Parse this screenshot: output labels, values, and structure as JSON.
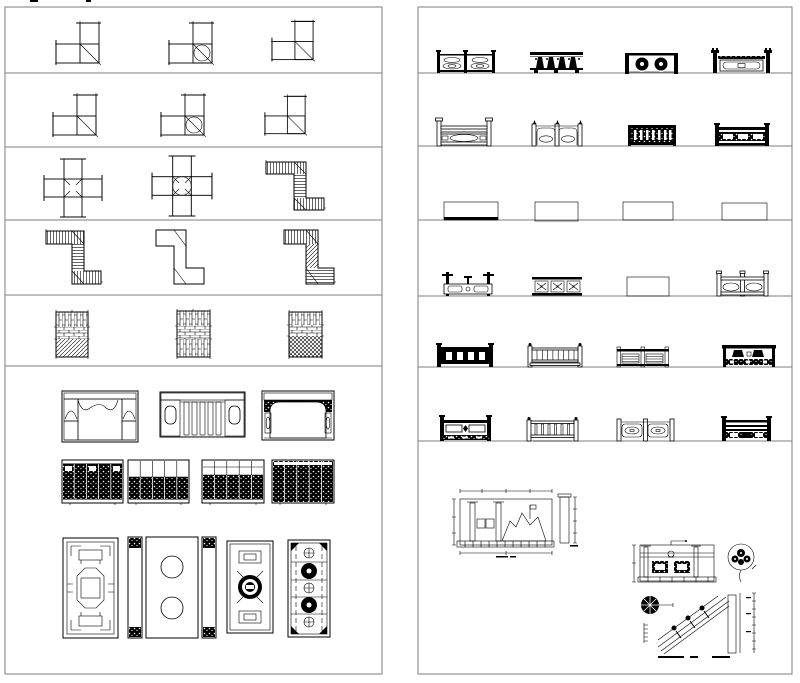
{
  "window": {
    "width": 800,
    "height": 683,
    "background": "#ffffff"
  },
  "style": {
    "ink": "#000000",
    "frame_line": "#7c7c7c",
    "paper": "#ffffff"
  },
  "sheets": [
    {
      "id": "left",
      "title": "brick-wall-junction-plans-and-lattice-screens",
      "rows": [
        {
          "id": "row-1",
          "items": [
            "brick-wall-l-corner-a",
            "brick-wall-l-corner-with-medallion-a",
            "brick-wall-l-corner-b"
          ]
        },
        {
          "id": "row-2",
          "items": [
            "brick-wall-l-corner-c",
            "brick-wall-l-corner-with-medallion-b",
            "brick-wall-l-corner-d"
          ]
        },
        {
          "id": "row-3",
          "items": [
            "brick-wall-cross-junction",
            "brick-wall-cross-junction-with-medallion",
            "brick-wall-z-corner-a"
          ]
        },
        {
          "id": "row-4",
          "items": [
            "brick-wall-z-corner-b",
            "brick-wall-z-corner-dark",
            "brick-wall-z-corner-c"
          ]
        },
        {
          "id": "row-5",
          "items": [
            "brick-bond-panel-a",
            "brick-bond-panel-b",
            "brick-bond-panel-c"
          ]
        },
        {
          "id": "row-6",
          "items": [
            "doorway-screen-curtain-arch",
            "doorway-screen-gate",
            "doorway-screen-wide-arch",
            "folding-screen-a",
            "folding-screen-b",
            "folding-screen-c",
            "folding-screen-d",
            "lattice-window-octagon",
            "lattice-window-ice-crack-triptych",
            "lattice-window-coin-medallion",
            "lattice-window-bead-column"
          ]
        }
      ]
    },
    {
      "id": "right",
      "title": "stone-railing-elevations-and-construction-details",
      "rows": [
        {
          "id": "row-1",
          "items": [
            "railing-chain-ovals",
            "railing-arch-balusters",
            "railing-floral-medallions",
            "railing-tall-posts-cartouche"
          ]
        },
        {
          "id": "row-2",
          "items": [
            "railing-bridge-oval",
            "railing-double-arch",
            "railing-spindles-dark",
            "railing-three-panel"
          ]
        },
        {
          "id": "row-3",
          "items": [
            "railing-dense-fret-a",
            "railing-dense-fret-b",
            "railing-dense-fret-c",
            "railing-dense-bars"
          ]
        },
        {
          "id": "row-4",
          "items": [
            "railing-wing-posts-openwork",
            "railing-cross-motifs",
            "railing-dark-star-panels",
            "railing-two-oval-bays"
          ]
        },
        {
          "id": "row-5",
          "items": [
            "railing-wide-balusters",
            "railing-thin-spindles",
            "railing-two-bay-slats",
            "railing-trapezoid-panel"
          ]
        },
        {
          "id": "row-6",
          "items": [
            "railing-paneled-base",
            "railing-vertical-bars",
            "railing-double-cartouche",
            "railing-stacked-rails"
          ]
        },
        {
          "id": "row-7",
          "items": [
            "detail-railing-with-rockery-elevation",
            "detail-stair-railing-section"
          ]
        }
      ]
    }
  ]
}
